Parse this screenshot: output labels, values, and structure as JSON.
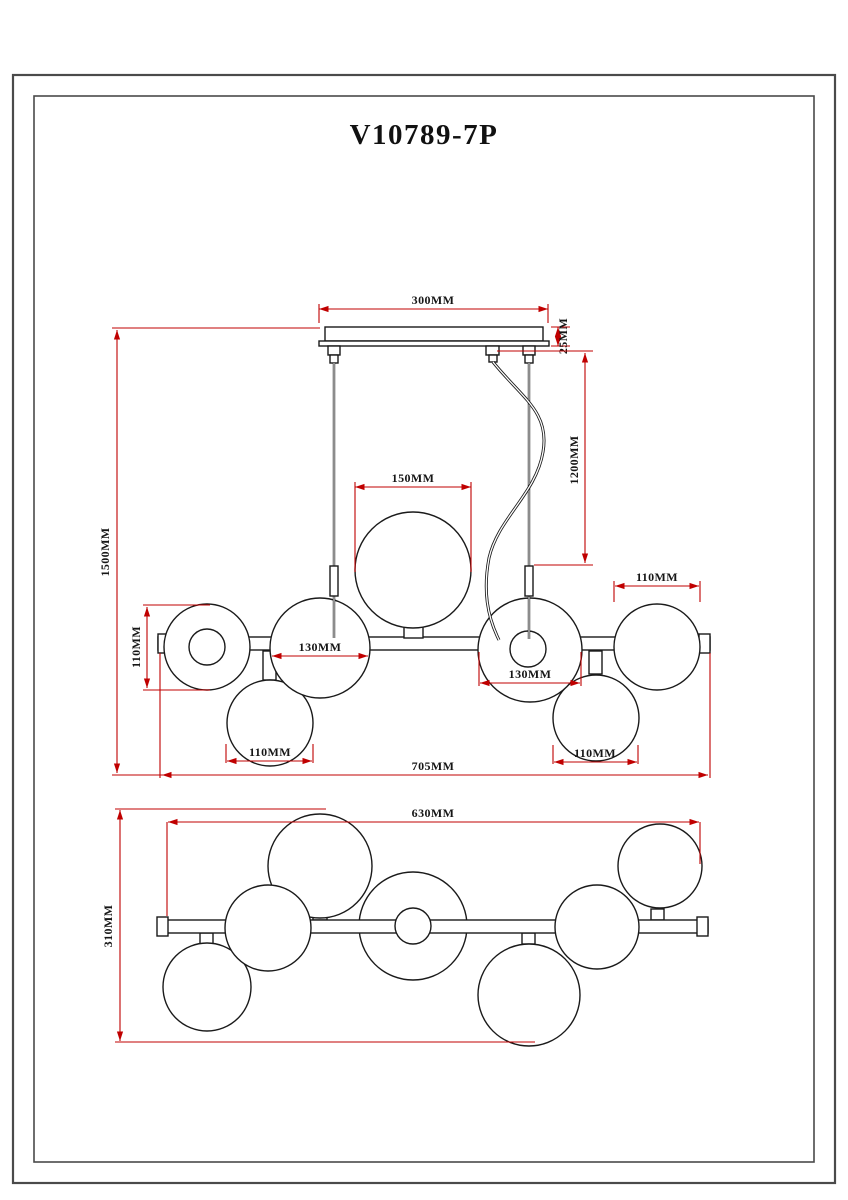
{
  "title": "V10789-7P",
  "colors": {
    "dimension_red": "#c00000",
    "drawing_line": "#1a1a1a",
    "frame_gray": "#4a4a4a"
  },
  "side_view": {
    "canopy_width": "300MM",
    "canopy_height": "25MM",
    "overall_height": "1500MM",
    "cord_length": "1200MM",
    "center_globe_diameter": "150MM",
    "left_globe_height": "110MM",
    "left_center_globe_diameter": "130MM",
    "right_center_globe_diameter": "130MM",
    "upper_right_globe_diameter": "110MM",
    "lower_left_globe_diameter": "110MM",
    "lower_right_globe_diameter": "110MM",
    "overall_width": "705MM"
  },
  "top_view": {
    "bar_length": "630MM",
    "overall_depth": "310MM"
  }
}
